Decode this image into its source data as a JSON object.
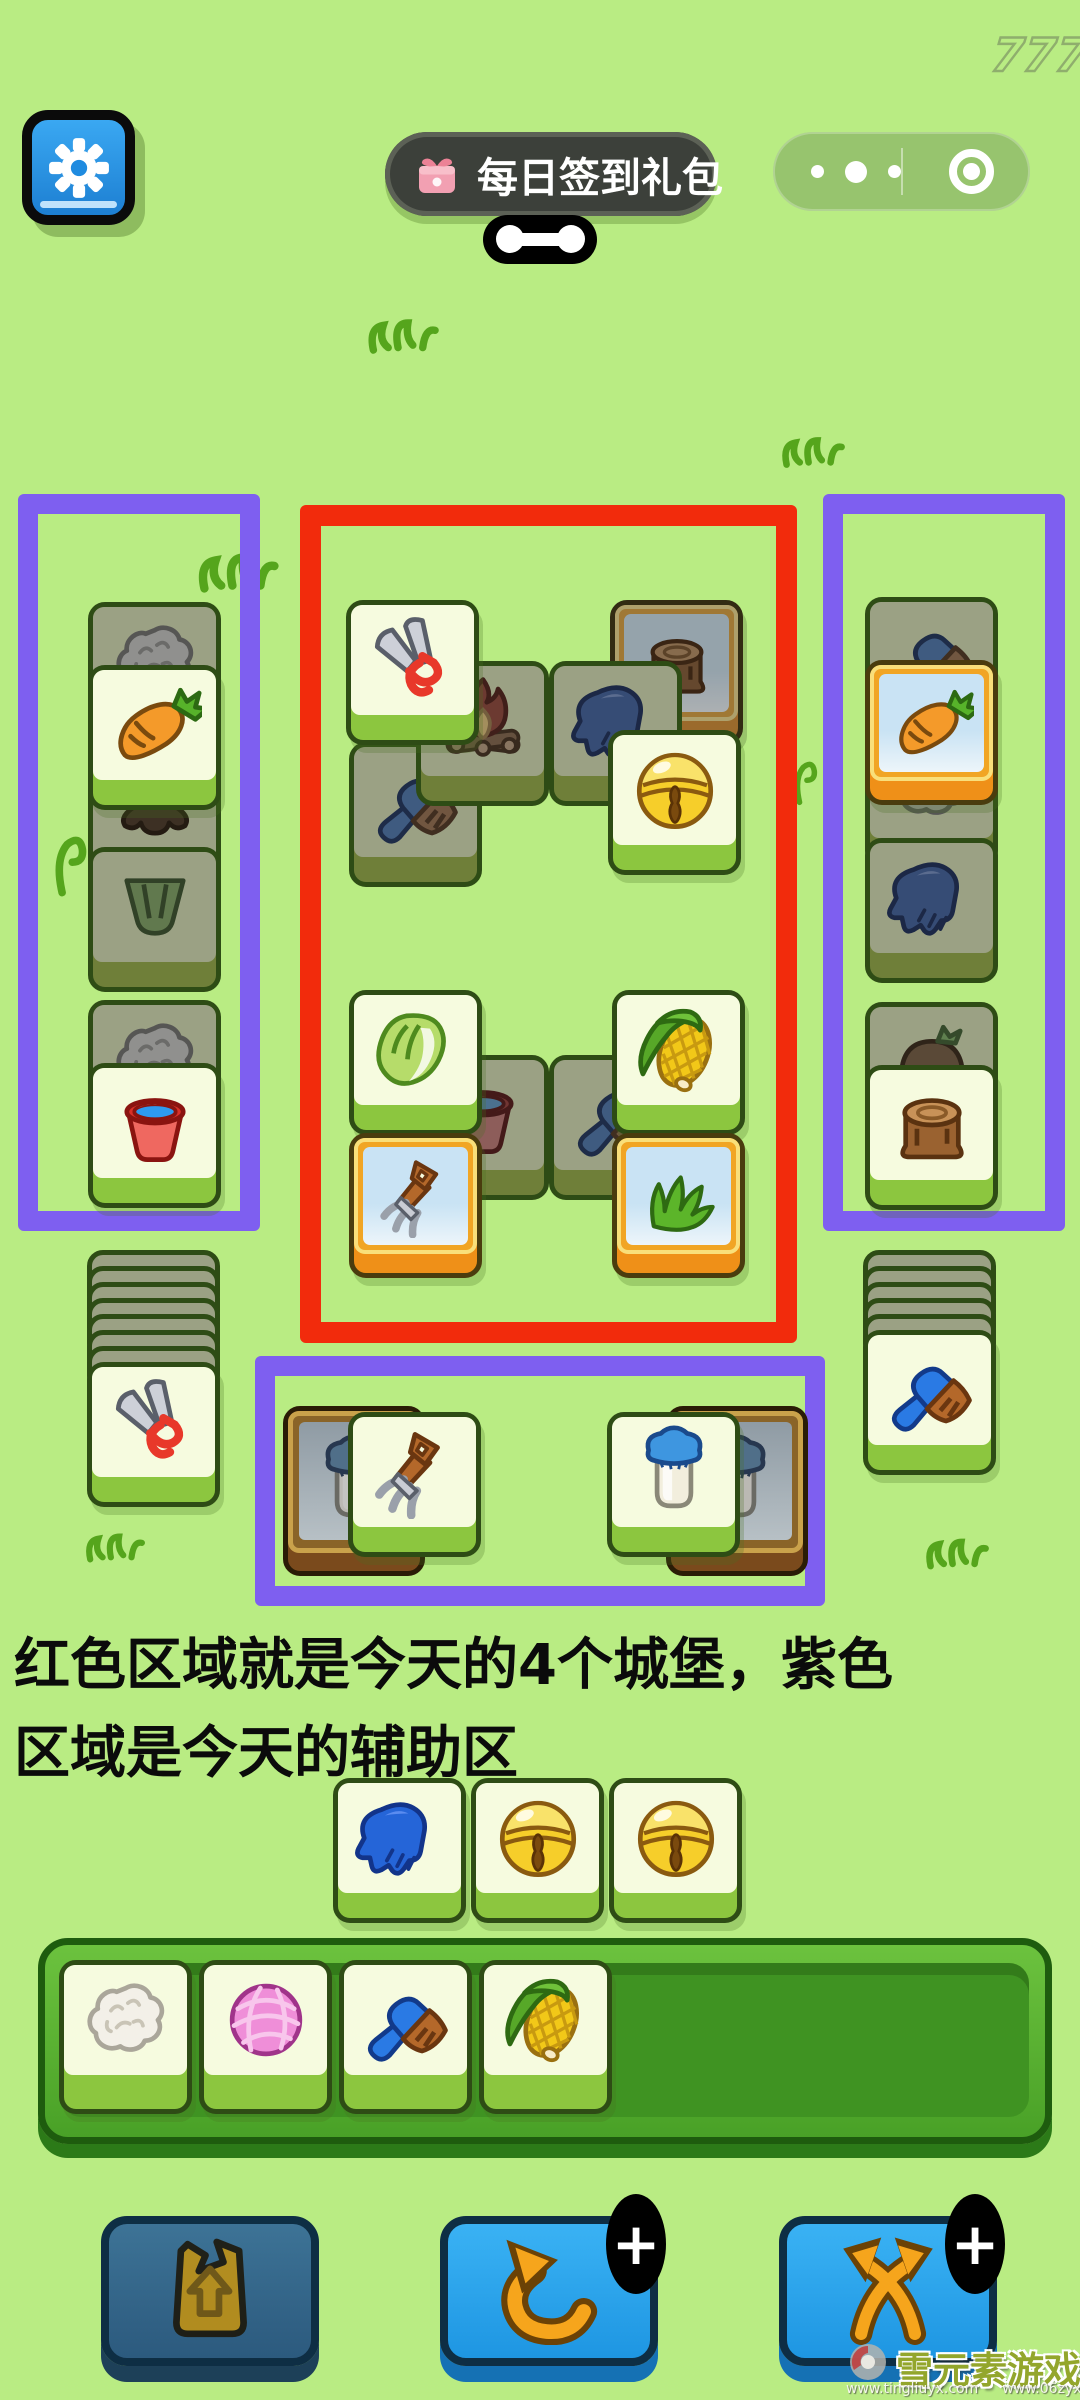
{
  "watermarks": {
    "top_number": "777",
    "brand": "雪元素游戏",
    "url1": "www.tingliuyx.com",
    "url2": "www.06zyx.com"
  },
  "topbar": {
    "daily_signin_label": "每日签到礼包",
    "gift_icon": "gift-icon",
    "more_icon": "more-dots-icon",
    "exit_icon": "record-icon"
  },
  "annotation": {
    "line1": "红色区域就是今天的4个城堡，紫色",
    "line2": "区域是今天的辅助区"
  },
  "zones": {
    "castle_color": "#f22b0c",
    "helper_color": "#7e5ff0"
  },
  "board": {
    "tiles": [
      {
        "icon": "wool",
        "kind": "dark",
        "x": 88,
        "y": 602
      },
      {
        "icon": "stumproot",
        "kind": "dark",
        "x": 88,
        "y": 745
      },
      {
        "icon": "leafbunch",
        "kind": "dark",
        "x": 88,
        "y": 847
      },
      {
        "icon": "carrot",
        "kind": "bright",
        "x": 88,
        "y": 665
      },
      {
        "icon": "wool",
        "kind": "dark",
        "x": 88,
        "y": 1000
      },
      {
        "icon": "bucket",
        "kind": "bright",
        "x": 88,
        "y": 1063
      },
      {
        "icon": "stump",
        "kind": "golddim",
        "x": 610,
        "y": 600
      },
      {
        "icon": "brush",
        "kind": "dark",
        "x": 349,
        "y": 742
      },
      {
        "icon": "fire",
        "kind": "dark",
        "x": 416,
        "y": 661
      },
      {
        "icon": "glove",
        "kind": "dark",
        "x": 549,
        "y": 661
      },
      {
        "icon": "shears",
        "kind": "bright",
        "x": 346,
        "y": 600
      },
      {
        "icon": "bell",
        "kind": "bright",
        "x": 608,
        "y": 730
      },
      {
        "icon": "bucket",
        "kind": "dark",
        "x": 416,
        "y": 1055
      },
      {
        "icon": "brush",
        "kind": "dark",
        "x": 549,
        "y": 1055
      },
      {
        "icon": "cabbage",
        "kind": "bright",
        "x": 349,
        "y": 990
      },
      {
        "icon": "corn",
        "kind": "bright",
        "x": 612,
        "y": 990
      },
      {
        "icon": "pitchfork",
        "kind": "gold",
        "x": 349,
        "y": 1133
      },
      {
        "icon": "grass",
        "kind": "gold",
        "x": 612,
        "y": 1133
      },
      {
        "icon": "brush",
        "kind": "dark",
        "x": 865,
        "y": 597
      },
      {
        "icon": "wool",
        "kind": "dark",
        "x": 865,
        "y": 723
      },
      {
        "icon": "carrot",
        "kind": "gold",
        "x": 865,
        "y": 660
      },
      {
        "icon": "glove",
        "kind": "dark",
        "x": 865,
        "y": 838
      },
      {
        "icon": "turnip",
        "kind": "dark",
        "x": 865,
        "y": 1002
      },
      {
        "icon": "stump",
        "kind": "bright",
        "x": 865,
        "y": 1065
      },
      {
        "icon": "milk",
        "kind": "slot",
        "x": 283,
        "y": 1406
      },
      {
        "icon": "pitchfork",
        "kind": "bright",
        "x": 348,
        "y": 1412
      },
      {
        "icon": "milk",
        "kind": "slot",
        "x": 666,
        "y": 1406
      },
      {
        "icon": "milk",
        "kind": "bright",
        "x": 607,
        "y": 1412
      }
    ],
    "piles": [
      {
        "x": 87,
        "y": 1250,
        "strips": 7,
        "top_icon": "shears"
      },
      {
        "x": 863,
        "y": 1250,
        "strips": 5,
        "top_icon": "brush"
      }
    ]
  },
  "queue_row": {
    "tiles": [
      "glove",
      "bell",
      "bell"
    ]
  },
  "collection_bar": {
    "tiles": [
      "cotton",
      "yarn",
      "brush",
      "corn"
    ]
  },
  "buttons": [
    {
      "name": "moveout-button",
      "icon": "bag",
      "badge": "",
      "disabled": true
    },
    {
      "name": "undo-button",
      "icon": "undo",
      "badge": "+",
      "disabled": false
    },
    {
      "name": "shuffle-button",
      "icon": "shuffle",
      "badge": "+",
      "disabled": false
    }
  ]
}
